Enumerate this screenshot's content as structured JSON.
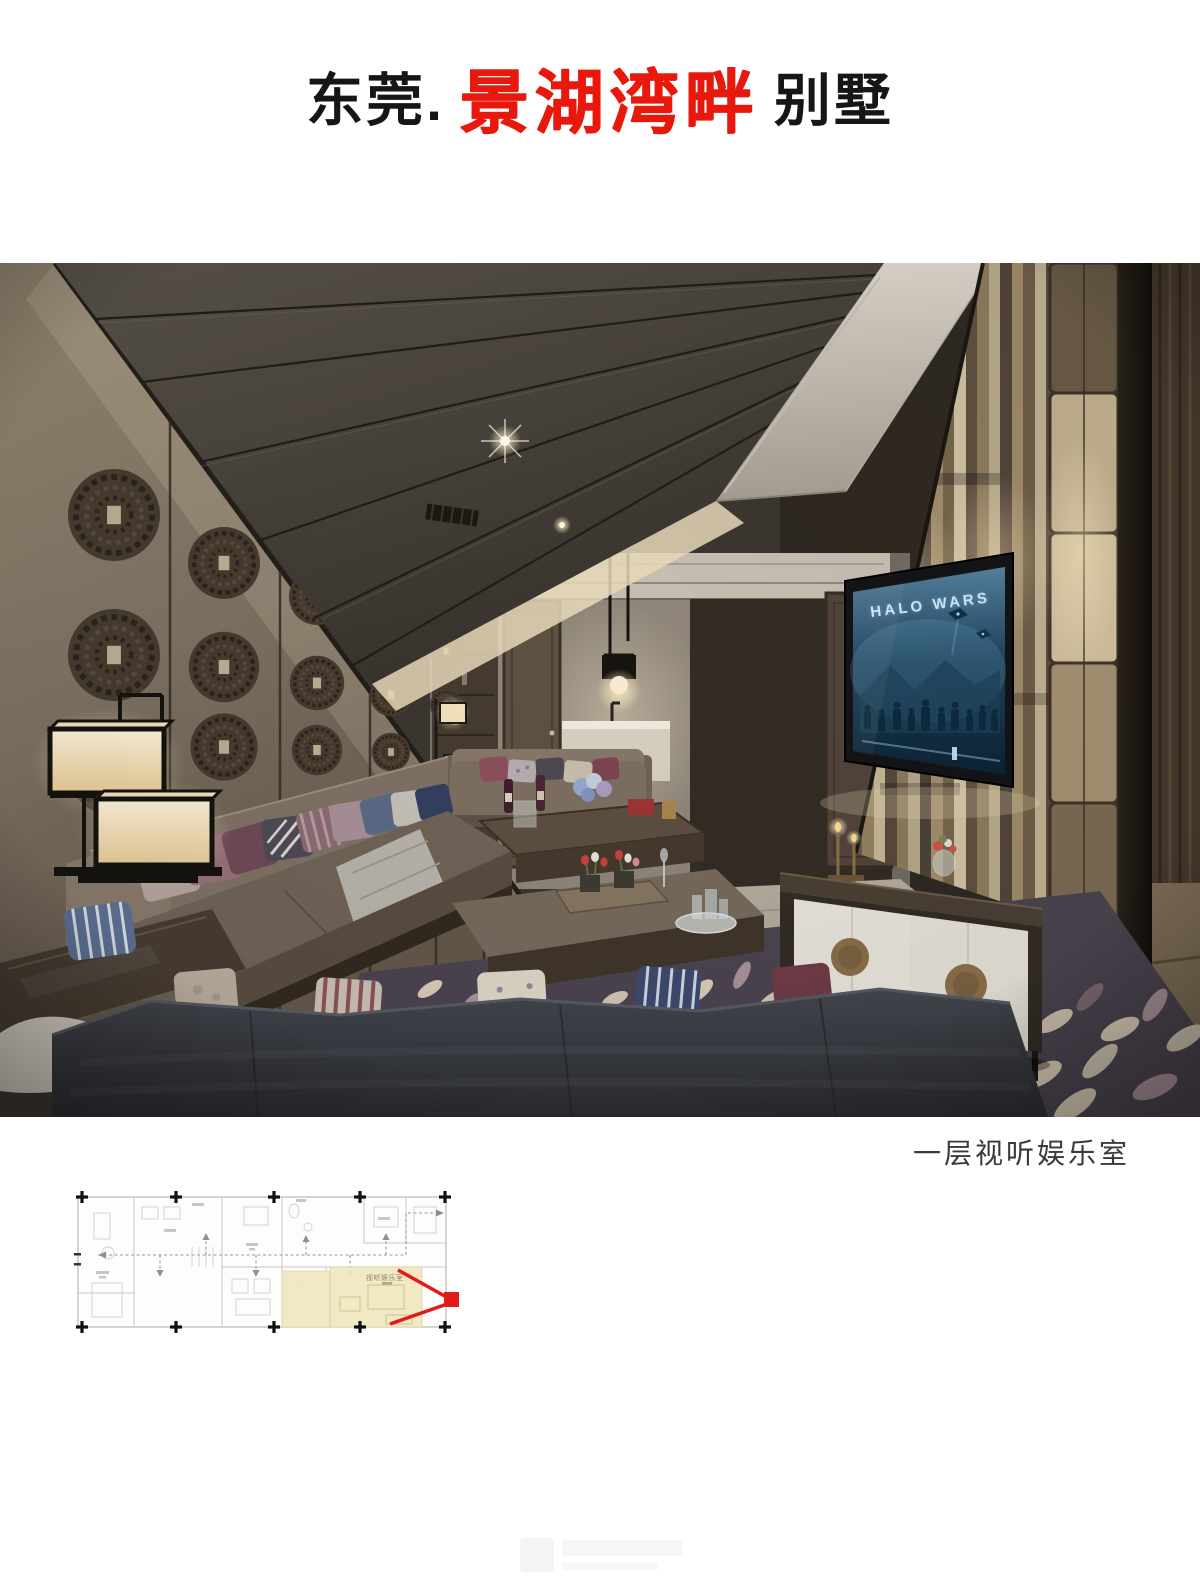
{
  "title": {
    "prefix": "东莞.",
    "highlight": "景湖湾畔",
    "suffix": "别墅",
    "highlight_color": "#e8190c"
  },
  "caption": "一层视听娱乐室",
  "photo": {
    "tv_screen_title": "HALO WARS"
  },
  "floor_plan": {
    "highlight_label": "视听娱乐室",
    "highlight_color": "#f0e8c2",
    "view_cone_color": "#e21a1a",
    "marker_color": "#111111"
  }
}
